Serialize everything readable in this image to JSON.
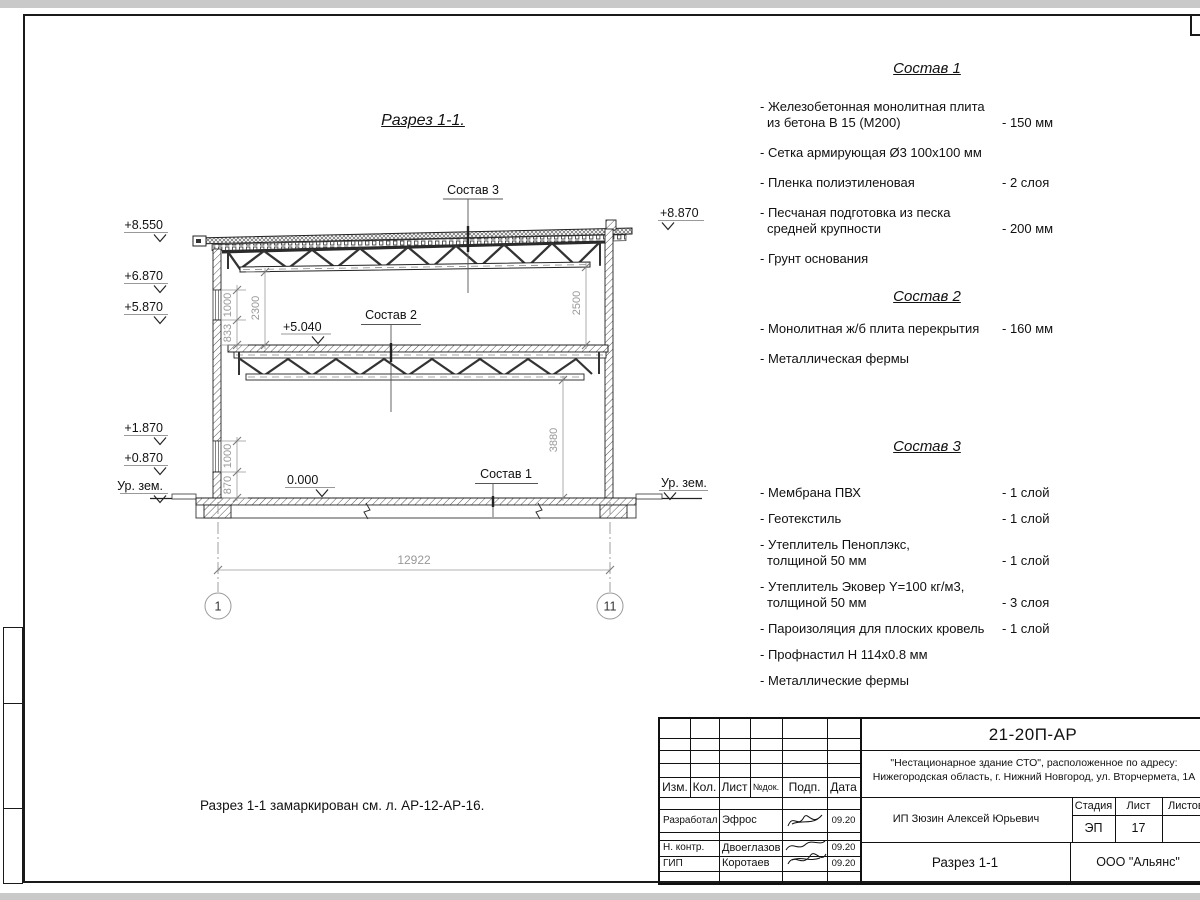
{
  "colors": {
    "line": "#1a1a1a",
    "dim_text": "#999999",
    "sheet_edge": "#c9c9c9"
  },
  "drawing": {
    "title": "Разрез 1-1.",
    "note": "Разрез 1-1 замаркирован см. л. АР-12-АР-16.",
    "labels": {
      "sostav1": "Состав 1",
      "sostav2": "Состав 2",
      "sostav3": "Состав 3",
      "level_mid": "+5.040",
      "level_zero": "0.000"
    },
    "elevations_left": [
      "+8.550",
      "+6.870",
      "+5.870",
      "+1.870",
      "+0.870",
      "Ур. зем."
    ],
    "elevations_right": [
      "+8.870",
      "Ур. зем."
    ],
    "dimensions": {
      "top_1000": "1000",
      "top_833": "833",
      "top_2300": "2300",
      "top_2500": "2500",
      "bot_1000": "1000",
      "bot_870": "870",
      "bot_3880": "3880",
      "span": "12922"
    },
    "axes": [
      "1",
      "11"
    ]
  },
  "compositions": [
    {
      "title": "Состав 1",
      "items": [
        {
          "line1": "- Железобетонная  монолитная плита",
          "line2": "из бетона В 15 (М200)",
          "value": "- 150 мм"
        },
        {
          "line1": "- Сетка армирующая Ø3 100х100 мм",
          "line2": "",
          "value": ""
        },
        {
          "line1": "- Пленка полиэтиленовая",
          "line2": "",
          "value": "- 2 слоя"
        },
        {
          "line1": "- Песчаная подготовка из песка",
          "line2": "средней крупности",
          "value": "- 200 мм"
        },
        {
          "line1": "- Грунт основания",
          "line2": "",
          "value": ""
        }
      ]
    },
    {
      "title": "Состав 2",
      "items": [
        {
          "line1": "- Монолитная ж/б плита перекрытия",
          "line2": "",
          "value": "- 160 мм"
        },
        {
          "line1": "- Металлическая фермы",
          "line2": "",
          "value": ""
        }
      ]
    },
    {
      "title": "Состав 3",
      "items": [
        {
          "line1": "- Мембрана ПВХ",
          "line2": "",
          "value": "- 1 слой"
        },
        {
          "line1": "- Геотекстиль",
          "line2": "",
          "value": "- 1 слой"
        },
        {
          "line1": "- Утеплитель Пеноплэкс,",
          "line2": "толщиной 50 мм",
          "value": "- 1 слой"
        },
        {
          "line1": "- Утеплитель Эковер Y=100 кг/м3,",
          "line2": "толщиной 50 мм",
          "value": "- 3 слоя"
        },
        {
          "line1": "- Пароизоляция для плоских кровель",
          "line2": "",
          "value": "- 1 слой"
        },
        {
          "line1": "- Профнастил Н 114х0.8 мм",
          "line2": "",
          "value": ""
        },
        {
          "line1": "- Металлические фермы",
          "line2": "",
          "value": ""
        }
      ]
    }
  ],
  "titleblock": {
    "doc_code": "21-20П-АР",
    "project_line1": "\"Нестационарное здание СТО\", расположенное по адресу:",
    "project_line2": "Нижегородская область, г. Нижний Новгород, ул. Вторчермета, 1А",
    "client": "ИП Зюзин Алексей Юрьевич",
    "sheet_title": "Разрез 1-1",
    "company": "ООО \"Альянс\"",
    "headers": {
      "izm": "Изм.",
      "kol": "Кол.",
      "list": "Лист",
      "ndok": "№док.",
      "podp": "Подп.",
      "data": "Дата",
      "stadia": "Стадия",
      "list2": "Лист",
      "listov": "Листов"
    },
    "stage_value": "ЭП",
    "sheet_value": "17",
    "rows": [
      {
        "role": "Разработал",
        "name": "Эфрос",
        "date": "09.20"
      },
      {
        "role": "Н. контр.",
        "name": "Двоеглазов",
        "date": "09.20"
      },
      {
        "role": "ГИП",
        "name": "Коротаев",
        "date": "09.20"
      }
    ]
  }
}
